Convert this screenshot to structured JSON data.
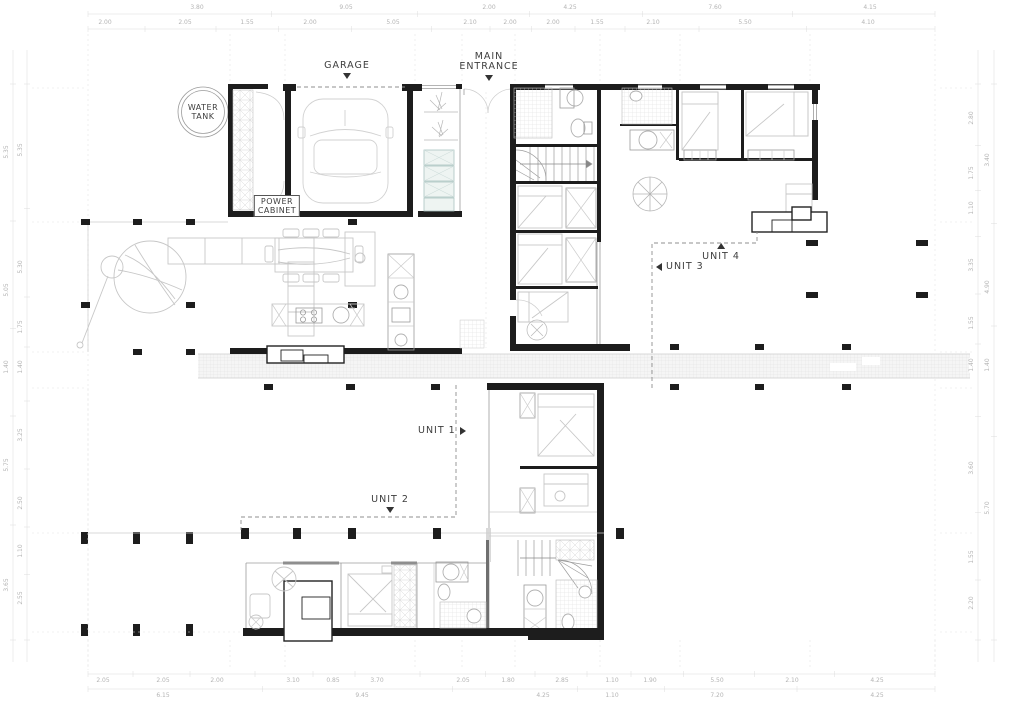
{
  "plan": {
    "labels": {
      "water_tank_line1": "WATER",
      "water_tank_line2": "TANK",
      "garage": "GARAGE",
      "main_entrance_line1": "MAIN",
      "main_entrance_line2": "ENTRANCE",
      "power_cabinet_line1": "POWER",
      "power_cabinet_line2": "CABINET",
      "unit_1": "UNIT 1",
      "unit_2": "UNIT 2",
      "unit_3": "UNIT 3",
      "unit_4": "UNIT 4"
    },
    "dimensions": {
      "top_row_outer": [
        "3.80",
        "9.05",
        "2.00",
        "4.25",
        "7.60",
        "4.15"
      ],
      "top_row_inner": [
        "2.00",
        "2.05",
        "1.55",
        "2.00",
        "5.05",
        "2.10",
        "2.00",
        "2.00",
        "1.55",
        "2.10",
        "5.50",
        "4.10"
      ],
      "bottom_row_inner": [
        "2.05",
        "2.05",
        "2.00",
        "3.10",
        "0.85",
        "3.70",
        "2.05",
        "1.80",
        "2.85",
        "1.10",
        "1.90",
        "5.50",
        "2.10",
        "4.25"
      ],
      "bottom_row_outer": [
        "6.15",
        "9.45",
        "4.25",
        "1.10",
        "7.20",
        "4.25"
      ],
      "left_col_inner": [
        "5.35",
        "5.30",
        "1.75",
        "1.40",
        "3.25",
        "2.50",
        "1.10",
        "2.55"
      ],
      "left_col_outer": [
        "5.35",
        "5.05",
        "1.40",
        "5.75",
        "3.65"
      ],
      "right_col_inner": [
        "2.80",
        "1.75",
        "1.10",
        "3.35",
        "1.55",
        "1.40",
        "3.60",
        "1.55",
        "2.20"
      ],
      "right_col_outer": [
        "3.40",
        "4.90",
        "1.40",
        "5.70"
      ]
    },
    "colors": {
      "wall": "#1d1d1d",
      "thin_line": "#9b9b9b",
      "furniture_line": "#c7c7c7",
      "dashed_boundary": "#8f8f8f",
      "dimension_text": "#b4b4b4",
      "label_text": "#3d3d3d",
      "locker_accent": "#aac4c0",
      "background": "#ffffff"
    }
  }
}
